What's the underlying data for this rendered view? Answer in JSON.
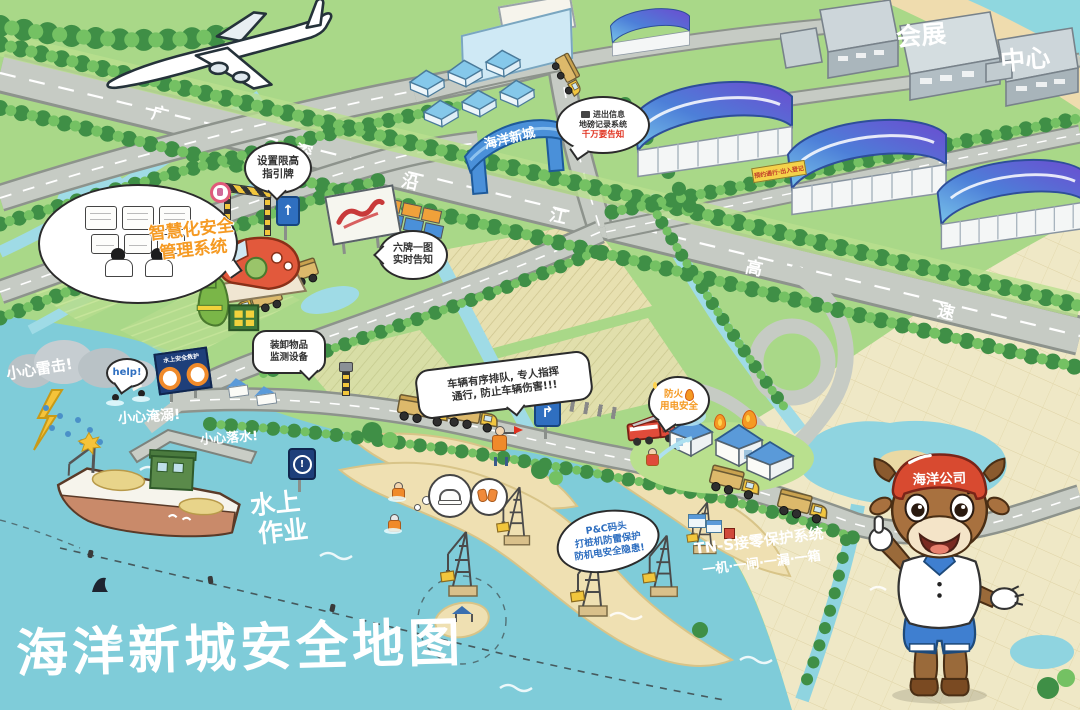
{
  "labels": {
    "title": "海洋新城安全地图"
  },
  "mascot": {
    "helmet": "海洋公司"
  },
  "gate": {
    "sign": "海洋新城"
  },
  "expo": {
    "l1": "会展",
    "l2": "中心"
  },
  "road": {
    "name": "广深沿江高速",
    "chars": [
      "广",
      "深",
      "沿",
      "江",
      "高",
      "速"
    ]
  },
  "bubbles": {
    "smart": {
      "l1": "智慧化安全",
      "l2": "管理系统"
    },
    "height": {
      "l1": "设置限高",
      "l2": "指引牌"
    },
    "weigh": {
      "l1": "进出信息",
      "l2": "地磅记录系统",
      "red": "千万要告知"
    },
    "boards": {
      "l1": "六牌一图",
      "l2": "实时告知"
    },
    "device": {
      "l1": "装卸物品",
      "l2": "监测设备"
    },
    "queue": {
      "l1": "车辆有序排队, 专人指挥",
      "l2": "通行, 防止车辆伤害!!!"
    },
    "fire": {
      "l1": "防火",
      "l2": "用电安全"
    },
    "pnc": {
      "l1": "P&C码头",
      "l2": "打桩机防雷保护",
      "l3": "防机电安全隐患!"
    },
    "help": "help!"
  },
  "water": {
    "lightning": "小心雷击!",
    "drowning": "小心淹溺!",
    "falling": "小心落水!",
    "work1": "水上",
    "work2": "作业",
    "tns1": "TN-S接零保护系统",
    "tns2": "一机·一闸·一漏·一箱"
  },
  "signs": {
    "banner": "预约通行·出入登记",
    "lifeguard": "水上安全救护",
    "arrow_up": "↑",
    "arrow_curve": "↱",
    "exclaim": "!"
  },
  "colors": {
    "water": "#7fccd9",
    "field_green": "#a9d888",
    "field_khaki": "#e7e0b0",
    "cream": "#efe8c6",
    "road": "#c6cbc4",
    "tree_dark": "#3f8f46",
    "tree_light": "#74c163",
    "warehouse_blue": "#4d7fd8",
    "warehouse_purple": "#6c4bd0",
    "sand": "#efe0b2",
    "mascot_red": "#d84a30",
    "accent_orange": "#f59a23",
    "title": "#ffffff"
  }
}
